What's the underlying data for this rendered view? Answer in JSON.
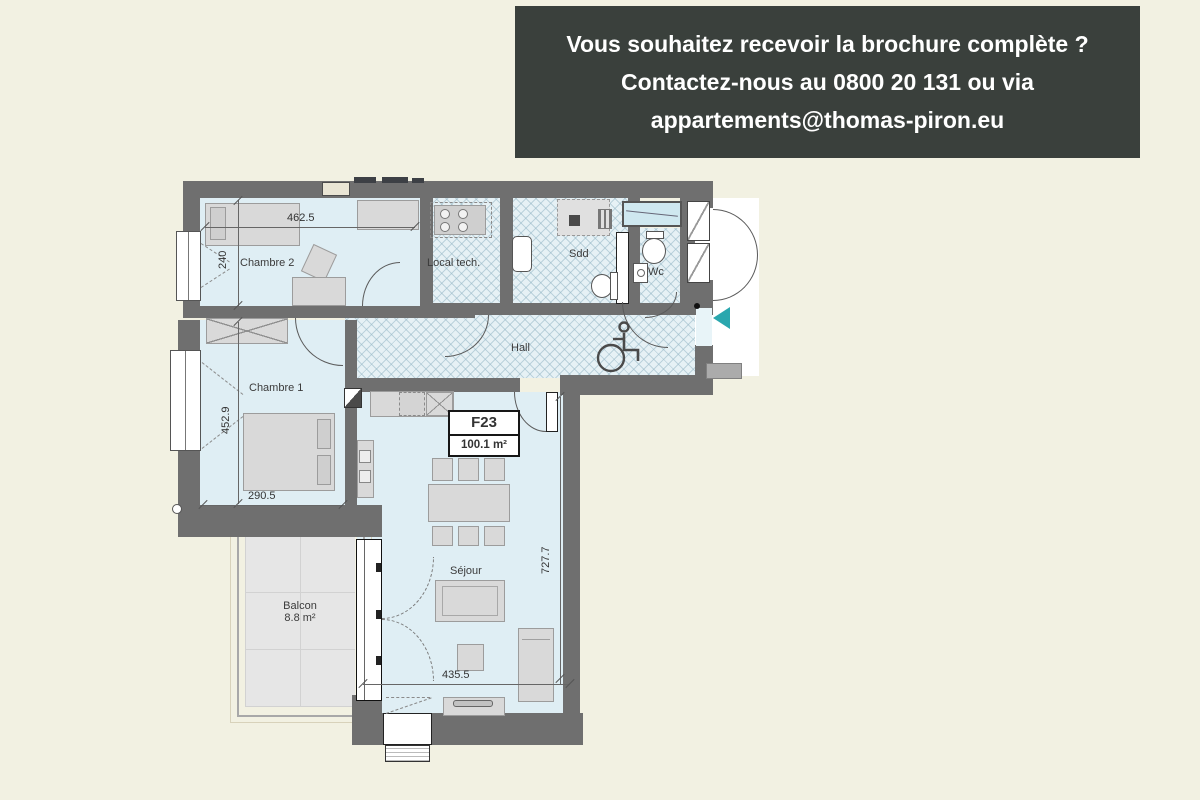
{
  "page": {
    "background": "#f2f1e2"
  },
  "banner": {
    "bg": "#3a403c",
    "text_color": "#ffffff",
    "lines": [
      "Vous souhaitez recevoir la brochure complète ?",
      "Contactez-nous au 0800 20 131 ou via",
      "appartements@thomas-piron.eu"
    ]
  },
  "plan": {
    "unit": {
      "code": "F23",
      "area": "100.1 m²"
    },
    "rooms": [
      {
        "id": "chambre2",
        "label": "Chambre 2"
      },
      {
        "id": "chambre1",
        "label": "Chambre 1"
      },
      {
        "id": "local_tech",
        "label": "Local tech."
      },
      {
        "id": "sdd",
        "label": "Sdd"
      },
      {
        "id": "wc",
        "label": "Wc"
      },
      {
        "id": "hall",
        "label": "Hall"
      },
      {
        "id": "sejour",
        "label": "Séjour"
      },
      {
        "id": "balcon",
        "label": "Balcon",
        "area": "8.8 m²"
      }
    ],
    "dimensions": [
      {
        "id": "top_width",
        "value": "462.5",
        "orientation": "horizontal"
      },
      {
        "id": "chambre2_depth",
        "value": "240",
        "orientation": "vertical"
      },
      {
        "id": "chambre1_depth",
        "value": "452.9",
        "orientation": "vertical"
      },
      {
        "id": "chambre1_width",
        "value": "290.5",
        "orientation": "horizontal"
      },
      {
        "id": "sejour_depth",
        "value": "727.7",
        "orientation": "vertical"
      },
      {
        "id": "sejour_width",
        "value": "435.5",
        "orientation": "horizontal"
      }
    ],
    "colors": {
      "wall": "#6f6f6f",
      "room_fill": "#dfeef4",
      "hatch_fill": "#e6f1f5",
      "furniture": "#d9d9d9",
      "balcony": "#e6e6e6",
      "entrance_arrow": "#2aa7ae"
    },
    "icons": [
      "wheelchair-icon",
      "entrance-arrow-icon"
    ]
  }
}
